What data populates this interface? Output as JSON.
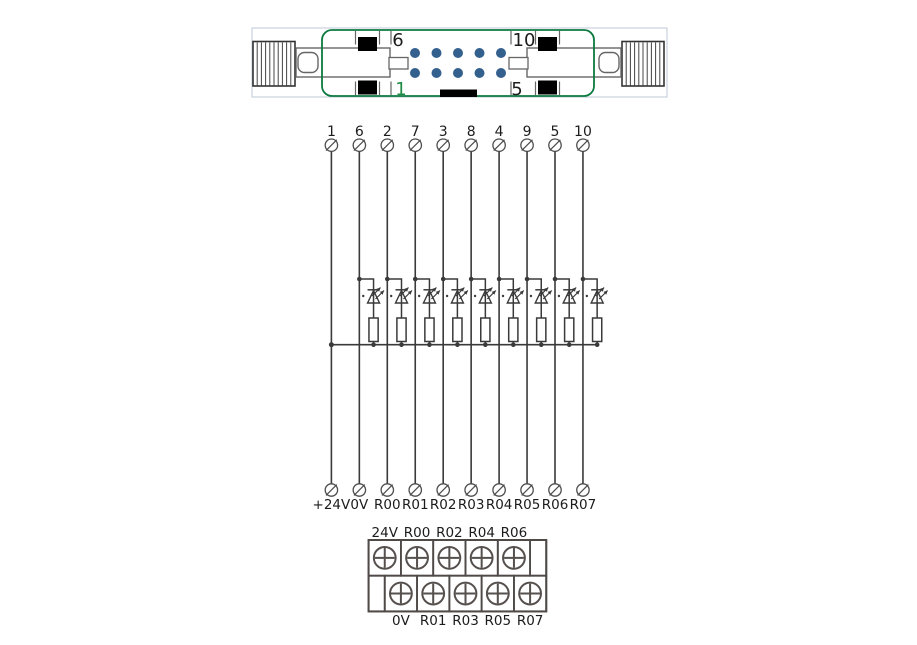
{
  "connector": {
    "pin_top_left": "6",
    "pin_top_right": "10",
    "pin_bottom_left": "1",
    "pin_bottom_right": "5",
    "pin_count": 10
  },
  "schematic": {
    "top_pins": [
      "1",
      "6",
      "2",
      "7",
      "3",
      "8",
      "4",
      "9",
      "5",
      "10"
    ],
    "bottom_labels": [
      "+24V",
      "0V",
      "R00",
      "R01",
      "R02",
      "R03",
      "R04",
      "R05",
      "R06",
      "R07"
    ],
    "led_branch_pins": [
      "6",
      "2",
      "7",
      "3",
      "8",
      "4",
      "9",
      "5",
      "10"
    ]
  },
  "terminal_block": {
    "top_labels": [
      "24V",
      "R00",
      "R02",
      "R04",
      "R06"
    ],
    "bottom_labels": [
      "0V",
      "R01",
      "R03",
      "R05",
      "R07"
    ]
  },
  "colors": {
    "connector_green": "#0c7a40",
    "pin_dot_blue": "#34608e",
    "outer_frame_gray": "#bdcad5",
    "wire_gray": "#3a3a3a",
    "terminal_block_border": "#4f4a47",
    "text_black": "#1c1c1c",
    "green_label": "#1f8b45"
  }
}
